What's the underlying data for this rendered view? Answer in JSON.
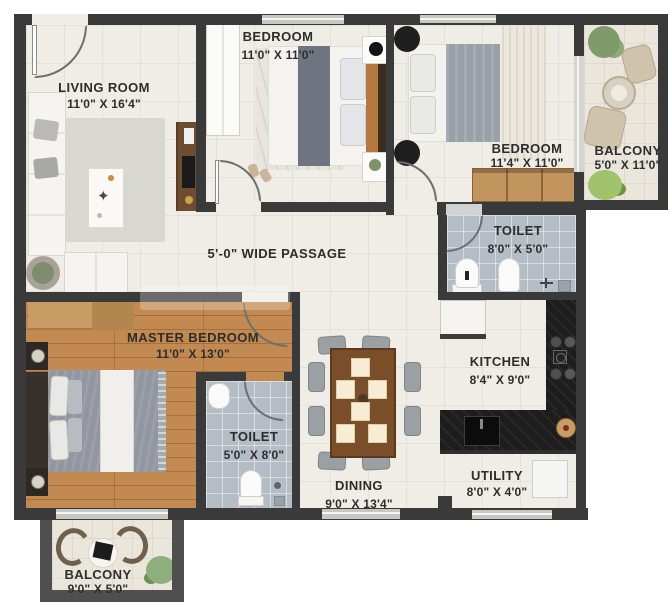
{
  "plan": {
    "passage_label": "5'-0\" WIDE PASSAGE",
    "rooms": [
      {
        "name": "LIVING ROOM",
        "dims": "11'0\" X 16'4\""
      },
      {
        "name": "BEDROOM",
        "dims": "11'0\" X 11'0\""
      },
      {
        "name": "BEDROOM",
        "dims": "11'4\" X 11'0\""
      },
      {
        "name": "BALCONY",
        "dims": "5'0\" X 11'0\""
      },
      {
        "name": "TOILET",
        "dims": "8'0\" X 5'0\""
      },
      {
        "name": "MASTER BEDROOM",
        "dims": "11'0\" X 13'0\""
      },
      {
        "name": "TOILET",
        "dims": "5'0\" X 8'0\""
      },
      {
        "name": "KITCHEN",
        "dims": "8'4\" X 9'0\""
      },
      {
        "name": "DINING",
        "dims": "9'0\" X 13'4\""
      },
      {
        "name": "UTILITY",
        "dims": "8'0\" X 4'0\""
      },
      {
        "name": "BALCONY",
        "dims": "9'0\" X 5'0\""
      }
    ],
    "colors": {
      "wall": "#3a3a3a",
      "tile_floor": "#f0ede6",
      "wood_floor": "#c28a50",
      "toilet_floor": "#b4bdc5",
      "balcony_floor": "#eae6db",
      "counter": "#1d1d1d",
      "wardrobe_wood": "#c2955f",
      "label_text": "#2d2d2d"
    }
  }
}
